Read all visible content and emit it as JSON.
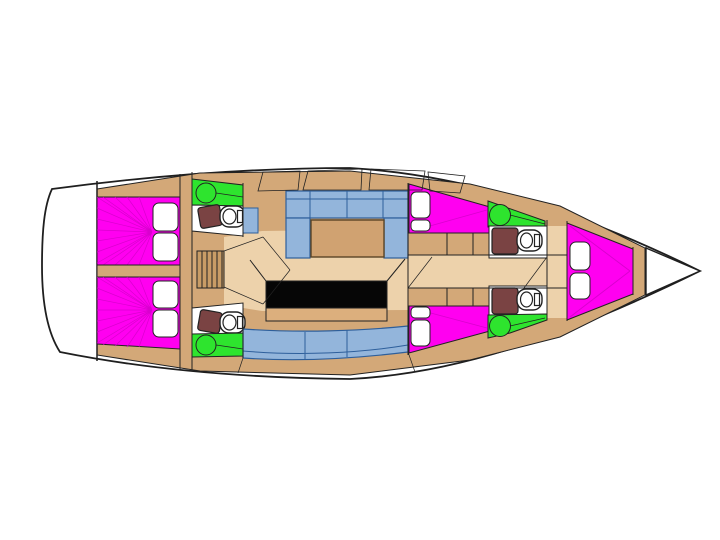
{
  "diagram": {
    "kind": "sailing-yacht-interior-floor-plan",
    "orientation": "bow-right",
    "features": [
      {
        "name": "hull"
      },
      {
        "name": "transom-platform"
      },
      {
        "name": "aft-cabin-port-berth"
      },
      {
        "name": "aft-cabin-starboard-berth"
      },
      {
        "name": "aft-head-port"
      },
      {
        "name": "aft-head-starboard"
      },
      {
        "name": "companionway-stairs"
      },
      {
        "name": "salon-settee"
      },
      {
        "name": "salon-table"
      },
      {
        "name": "galley-counter"
      },
      {
        "name": "starboard-bench"
      },
      {
        "name": "mid-cabin-port-berth"
      },
      {
        "name": "mid-cabin-starboard-berth"
      },
      {
        "name": "forward-head-port"
      },
      {
        "name": "forward-head-starboard"
      },
      {
        "name": "v-berth"
      },
      {
        "name": "bow-locker"
      }
    ],
    "counts": {
      "berths": 5,
      "heads": 4,
      "showers": 4,
      "toilets": 4,
      "pillows": 10
    }
  },
  "colors": {
    "hull_fill": "#FFFFFF",
    "outline": "#1F1F1F",
    "deck": "#D3A878",
    "floor": "#EDD2AB",
    "stairs": "#C89C66",
    "berth": "#FF00F0",
    "berth_line": "#D900CE",
    "pillow": "#FFFFFF",
    "shower": "#2EE42E",
    "settee": "#93B5DB",
    "settee_line": "#2E5F9B",
    "sink": "#93B5DB",
    "galley": "#060606",
    "counter": "#DCAF7D",
    "table": "#D0A271",
    "table_line": "#5A4526",
    "seat": "#7A4343",
    "fixture": "#FFFFFF",
    "line": "#222222",
    "bow_locker": "#FFFFFF"
  }
}
